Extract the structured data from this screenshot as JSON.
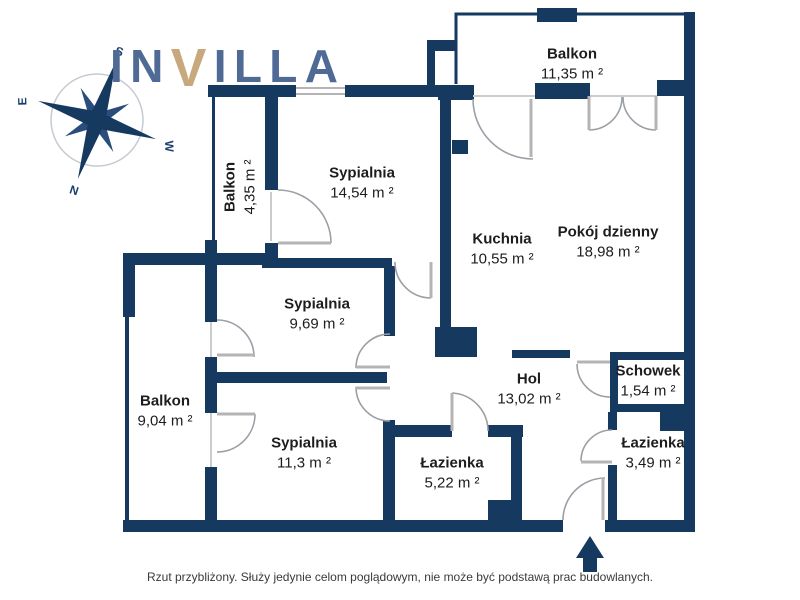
{
  "brand": {
    "pre": "IN",
    "v": "V",
    "post": "ILLA"
  },
  "compass": {
    "s": "S",
    "w": "W",
    "n": "N",
    "e": "E"
  },
  "rooms": [
    {
      "id": "balkon-top",
      "name": "Balkon",
      "area": "11,35 m ²"
    },
    {
      "id": "sypialnia-1",
      "name": "Sypialnia",
      "area": "14,54 m ²"
    },
    {
      "id": "balkon-left",
      "name": "Balkon",
      "area": "4,35 m ²"
    },
    {
      "id": "kuchnia",
      "name": "Kuchnia",
      "area": "10,55 m ²"
    },
    {
      "id": "pokoj-dzienny",
      "name": "Pokój dzienny",
      "area": "18,98 m ²"
    },
    {
      "id": "sypialnia-2",
      "name": "Sypialnia",
      "area": "9,69 m ²"
    },
    {
      "id": "balkon-lower",
      "name": "Balkon",
      "area": "9,04 m ²"
    },
    {
      "id": "sypialnia-3",
      "name": "Sypialnia",
      "area": "11,3 m ²"
    },
    {
      "id": "hol",
      "name": "Hol",
      "area": "13,02 m ²"
    },
    {
      "id": "schowek",
      "name": "Schowek",
      "area": "1,54 m ²"
    },
    {
      "id": "lazienka-mala",
      "name": "Łazienka",
      "area": "3,49 m ²"
    },
    {
      "id": "lazienka-duza",
      "name": "Łazienka",
      "area": "5,22 m ²"
    }
  ],
  "disclaimer": "Rzut przybliżony. Służy jedynie celom poglądowym, nie może być podstawą prac budowlanych.",
  "colors": {
    "wall": "#16395f",
    "logo_blue": "#4e6a95",
    "logo_accent": "#c8a87d",
    "door": "#9aa0a6",
    "text": "#1d1d1f"
  }
}
